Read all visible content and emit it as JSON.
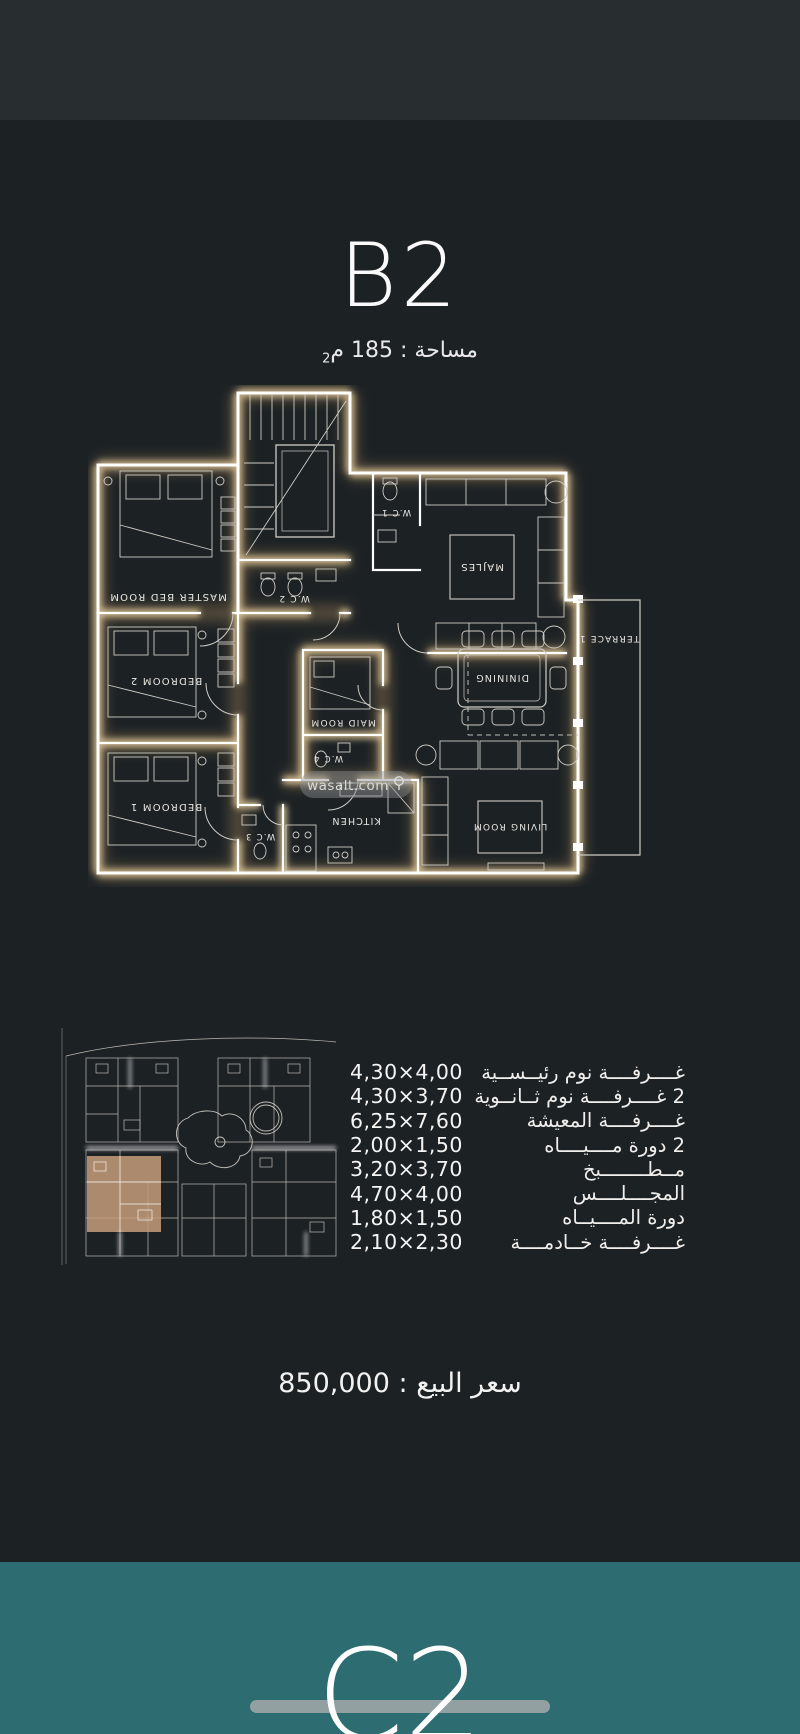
{
  "header": {
    "title": "B2",
    "area_prefix": "مساحة : 185 م",
    "area_sup": "2"
  },
  "floorplan": {
    "labels": {
      "master": "MASTER BED ROOM",
      "bedroom2": "BEDROOM 2",
      "bedroom1": "BEDROOM 1",
      "maid": "MAID ROOM",
      "kitchen": "KITCHEN",
      "dining": "DININING",
      "living": "LIVING ROOM",
      "majles": "MAJLES",
      "terrace": "TERRACE 1",
      "wc1": "W.C 1",
      "wc2": "W.C 2",
      "wc3": "W.C 3",
      "wc4": "W.C 4"
    },
    "watermark": "wasalt.com"
  },
  "dimensions": {
    "rows": [
      {
        "value": "4,30×4,00",
        "label": "غــــرفــــة نوم رئيــســية"
      },
      {
        "value": "4,30×3,70",
        "label": "2 غــــرفــــة نوم ثــانــوية"
      },
      {
        "value": "6,25×7,60",
        "label": "غــــرفــــة المعيشة"
      },
      {
        "value": "2,00×1,50",
        "label": "2 دورة مــــيــــاه"
      },
      {
        "value": "3,20×3,70",
        "label": "مــطــــــــبخ"
      },
      {
        "value": "4,70×4,00",
        "label": "المجــــلــــس"
      },
      {
        "value": "1,80×1,50",
        "label": "دورة المــــيــاه"
      },
      {
        "value": "2,10×2,30",
        "label": "غــــرفــــة خــادمــــة"
      }
    ]
  },
  "price": {
    "label": "سعر البيع",
    "colon": ":",
    "value": "850,000"
  },
  "next_section": {
    "title": "C2"
  },
  "colors": {
    "background_dark": "#1c2124",
    "background_top": "#282d30",
    "teal_section": "#2d6c70",
    "wall_glow": "#ecd3a2",
    "highlight_unit": "#c59c7a"
  }
}
